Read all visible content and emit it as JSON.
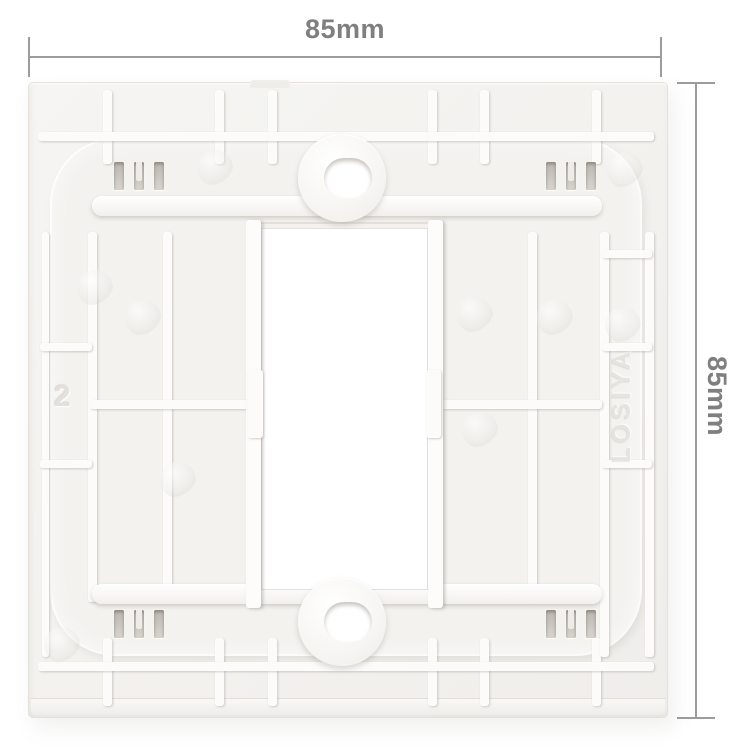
{
  "annotations": {
    "width_label": "85mm",
    "height_label": "85mm"
  },
  "plate_markings": {
    "mold_number": "2",
    "brand_emboss": "LOSIYA"
  },
  "colors": {
    "background": "#ffffff",
    "dimension_line": "#9c9c9c",
    "dimension_text": "#7f7f7f",
    "plate_base": "#f3f2ef",
    "plate_highlight": "#fcfbfa",
    "plate_shadow": "#d9d5d0",
    "slot_dark": "#bcb7b0",
    "opening": "#ffffff"
  }
}
